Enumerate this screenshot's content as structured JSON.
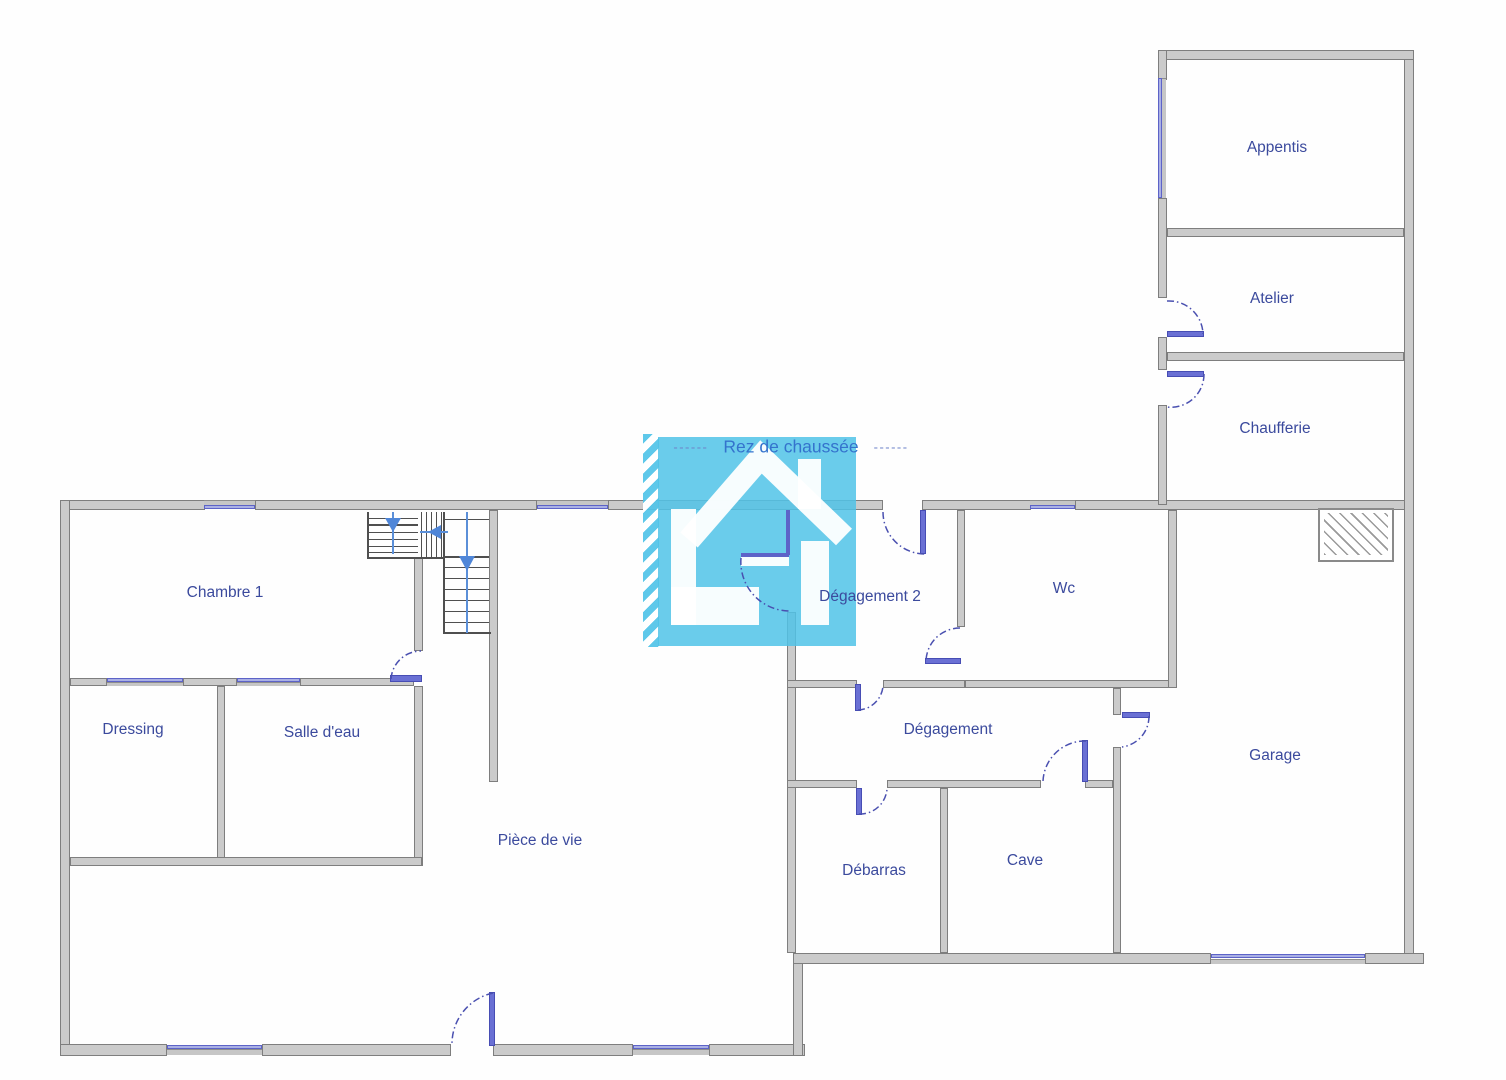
{
  "title": {
    "text": "Rez de chaussée",
    "dashes": "------"
  },
  "rooms": {
    "appentis": "Appentis",
    "atelier": "Atelier",
    "chaufferie": "Chaufferie",
    "chambre1": "Chambre 1",
    "dressing": "Dressing",
    "salle_deau": "Salle d'eau",
    "piece_de_vie": "Pièce de vie",
    "degagement2": "Dégagement 2",
    "wc": "Wc",
    "degagement": "Dégagement",
    "debarras": "Débarras",
    "cave": "Cave",
    "garage": "Garage"
  },
  "logo": {
    "icon": "house-logo",
    "color": "#50c3e8"
  },
  "colors": {
    "wall_fill": "#cbcbcb",
    "wall_edge": "#7e7e7e",
    "opening_blue": "#5d63c8",
    "arc_blue": "#4a50b0",
    "label_blue": "#3b4a9d",
    "title_blue": "#3473cd",
    "stair_arrow_blue": "#4f86d8",
    "logo_blue": "#50c3e8"
  }
}
